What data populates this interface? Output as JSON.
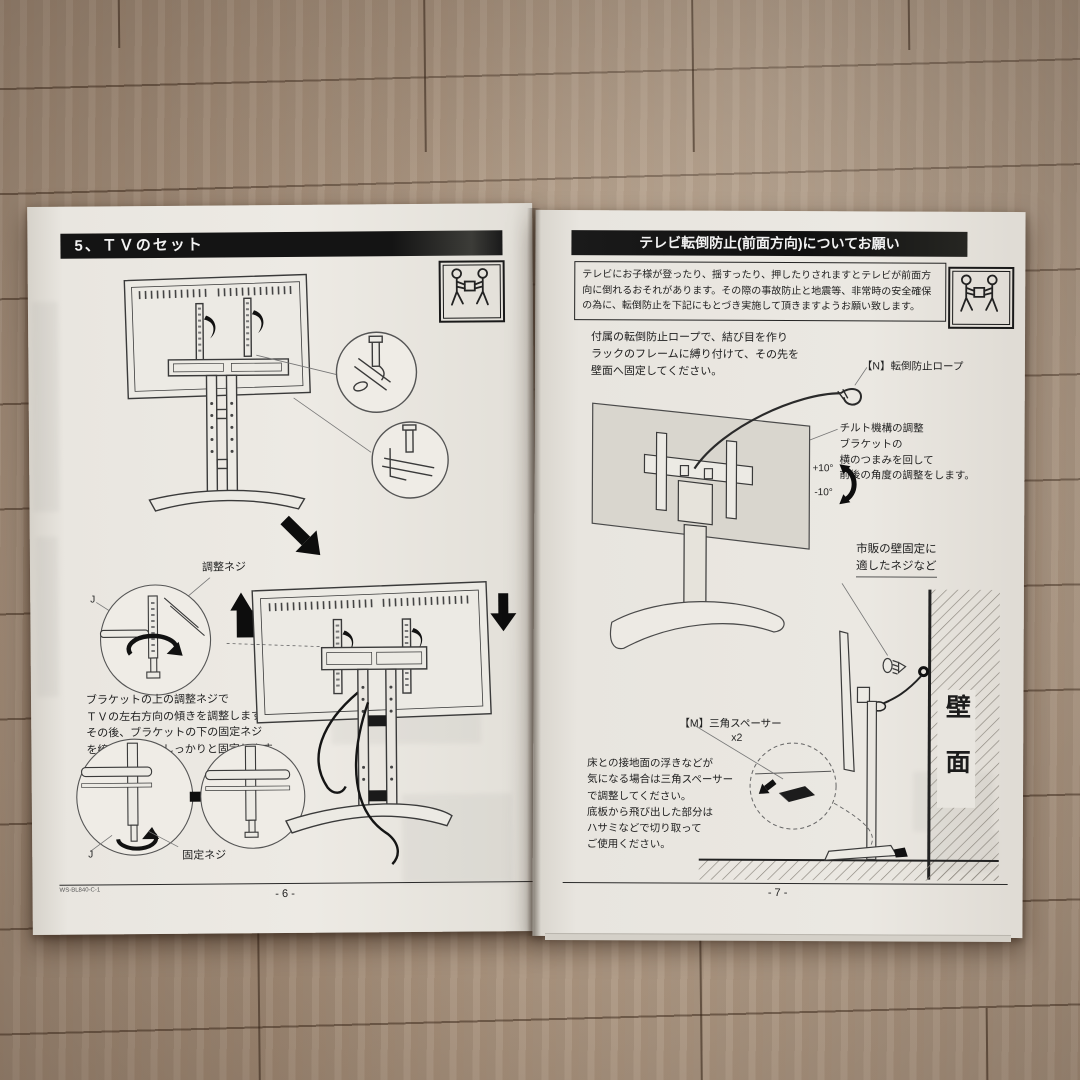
{
  "colors": {
    "paper": "#e9e6e0",
    "header_bar": "#161616",
    "wood": "#ab9480",
    "line_art": "#3a3a3a"
  },
  "icons": {
    "carry_warning": "two-person-carry-tv-icon",
    "hatch": "wall-hatch-pattern"
  },
  "left_page": {
    "header": "5、ＴＶのセット",
    "adjust_screw_label": "調整ネジ",
    "fix_screw_label": "固定ネジ",
    "j_label": "J",
    "body_text": "ブラケットの上の調整ネジで\nＴＶの左右方向の傾きを調整します。\nその後、ブラケットの下の固定ネジ\nを締め付けて、しっかりと固定します。",
    "footer_code": "WS-BL840-C-1",
    "page_number": "- 6 -"
  },
  "right_page": {
    "header": "テレビ転倒防止(前面方向)についてお願い",
    "notice": "テレビにお子様が登ったり、揺すったり、押したりされますとテレビが前面方\n向に倒れるおそれがあります。その際の事故防止と地震等、非常時の安全確保\nの為に、転倒防止を下記にもとづき実施して頂きますようお願い致します。",
    "rope_instruction": "付属の転倒防止ロープで、結び目を作り\nラックのフレームに縛り付けて、その先を\n壁面へ固定してください。",
    "rope_label": "【N】転倒防止ロープ",
    "tilt_note": "チルト機構の調整\nブラケットの\n横のつまみを回して\n前後の角度の調整をします。",
    "tilt_plus": "+10°",
    "tilt_minus": "-10°",
    "wall_screw_label": "市販の壁固定に\n適したネジなど",
    "wall_label": "壁面",
    "spacer_label": "【M】三角スペーサー",
    "spacer_qty": "x2",
    "floor_note": "床との接地面の浮きなどが\n気になる場合は三角スペーサー\nで調整してください。\n底板から飛び出した部分は\nハサミなどで切り取って\nご使用ください。",
    "page_number": "- 7 -"
  }
}
